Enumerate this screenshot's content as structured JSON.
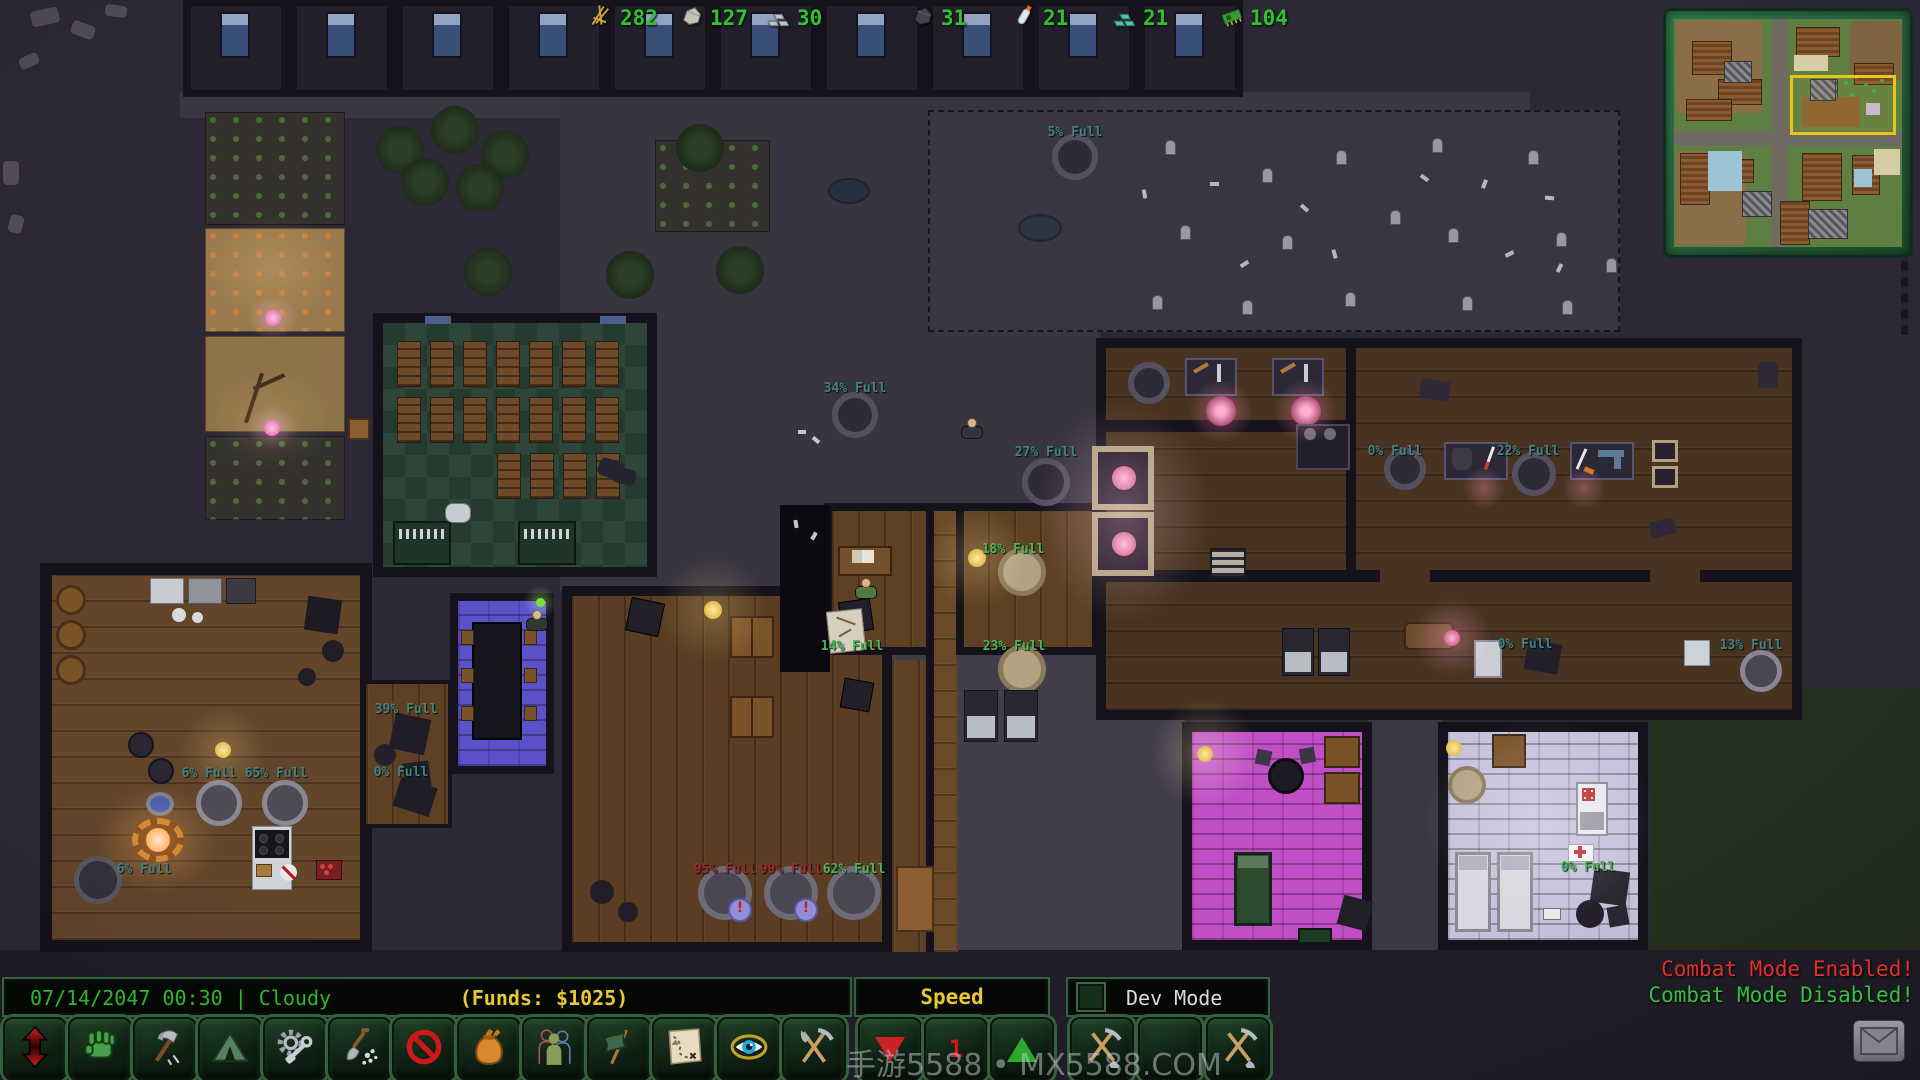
{
  "resources": [
    {
      "name": "branches",
      "icon": "branches",
      "value": "282"
    },
    {
      "name": "stone",
      "icon": "stone",
      "value": "127"
    },
    {
      "name": "metal",
      "icon": "metal",
      "value": "30"
    },
    {
      "name": "coal",
      "icon": "coal",
      "value": "31"
    },
    {
      "name": "water",
      "icon": "water",
      "value": "21"
    },
    {
      "name": "glass",
      "icon": "glass",
      "value": "21"
    },
    {
      "name": "electronics",
      "icon": "chip",
      "value": "104"
    }
  ],
  "map_labels": [
    {
      "text": "5% Full",
      "x": 1075,
      "y": 125,
      "tone": "teal"
    },
    {
      "text": "34% Full",
      "x": 855,
      "y": 381,
      "tone": "teal"
    },
    {
      "text": "27% Full",
      "x": 1046,
      "y": 445,
      "tone": "teal"
    },
    {
      "text": "18% Full",
      "x": 1013,
      "y": 542,
      "tone": "green"
    },
    {
      "text": "14% Full",
      "x": 852,
      "y": 639,
      "tone": "green"
    },
    {
      "text": "23% Full",
      "x": 1014,
      "y": 639,
      "tone": "green"
    },
    {
      "text": "39% Full",
      "x": 406,
      "y": 702,
      "tone": "teal"
    },
    {
      "text": "0% Full",
      "x": 401,
      "y": 765,
      "tone": "teal"
    },
    {
      "text": "6% Full",
      "x": 209,
      "y": 766,
      "tone": "teal"
    },
    {
      "text": "65% Full",
      "x": 276,
      "y": 766,
      "tone": "teal"
    },
    {
      "text": "6% Full",
      "x": 144,
      "y": 862,
      "tone": "teal"
    },
    {
      "text": "95% Full",
      "x": 725,
      "y": 862,
      "tone": "red"
    },
    {
      "text": "99% Full",
      "x": 791,
      "y": 862,
      "tone": "red"
    },
    {
      "text": "62% Full",
      "x": 854,
      "y": 862,
      "tone": "green"
    },
    {
      "text": "0% Full",
      "x": 1395,
      "y": 444,
      "tone": "teal"
    },
    {
      "text": "22% Full",
      "x": 1528,
      "y": 444,
      "tone": "teal"
    },
    {
      "text": "0% Full",
      "x": 1525,
      "y": 637,
      "tone": "teal"
    },
    {
      "text": "13% Full",
      "x": 1751,
      "y": 638,
      "tone": "teal"
    },
    {
      "text": "0% Full",
      "x": 1588,
      "y": 860,
      "tone": "green"
    }
  ],
  "container_badges": [
    {
      "char": "!",
      "x": 728,
      "y": 898
    },
    {
      "char": "!",
      "x": 794,
      "y": 898
    }
  ],
  "status_bar": {
    "datetime": "07/14/2047 00:30",
    "separator": "|",
    "weather": "Cloudy",
    "funds": "(Funds: $1025)"
  },
  "speed_panel": {
    "title": "Speed",
    "value": "1"
  },
  "dev_panel": {
    "label": "Dev Mode"
  },
  "combat": {
    "enabled": "Combat Mode Enabled!",
    "disabled": "Combat Mode Disabled!"
  },
  "watermark": "手游5588 • MX5588.COM",
  "toolbar": {
    "buttons": [
      "priority-arrows",
      "work-fist",
      "build-hammer",
      "camp-tent",
      "mechanics-gear",
      "dig-shovel",
      "forbid-sign",
      "stockpile-sack",
      "colonists",
      "missions-flag",
      "world-map",
      "visibility-eye",
      "harvest-tools"
    ]
  },
  "dev_buttons": [
    "dig-tools",
    "blank",
    "dig-tools"
  ],
  "colors": {
    "ui_green": "#2db92d",
    "funds_yellow": "#e8c832",
    "label_teal": "#3e8383",
    "label_green": "#49b657",
    "label_red": "#9e2b2b",
    "combat_red": "#e23030",
    "combat_green": "#32c23c"
  }
}
